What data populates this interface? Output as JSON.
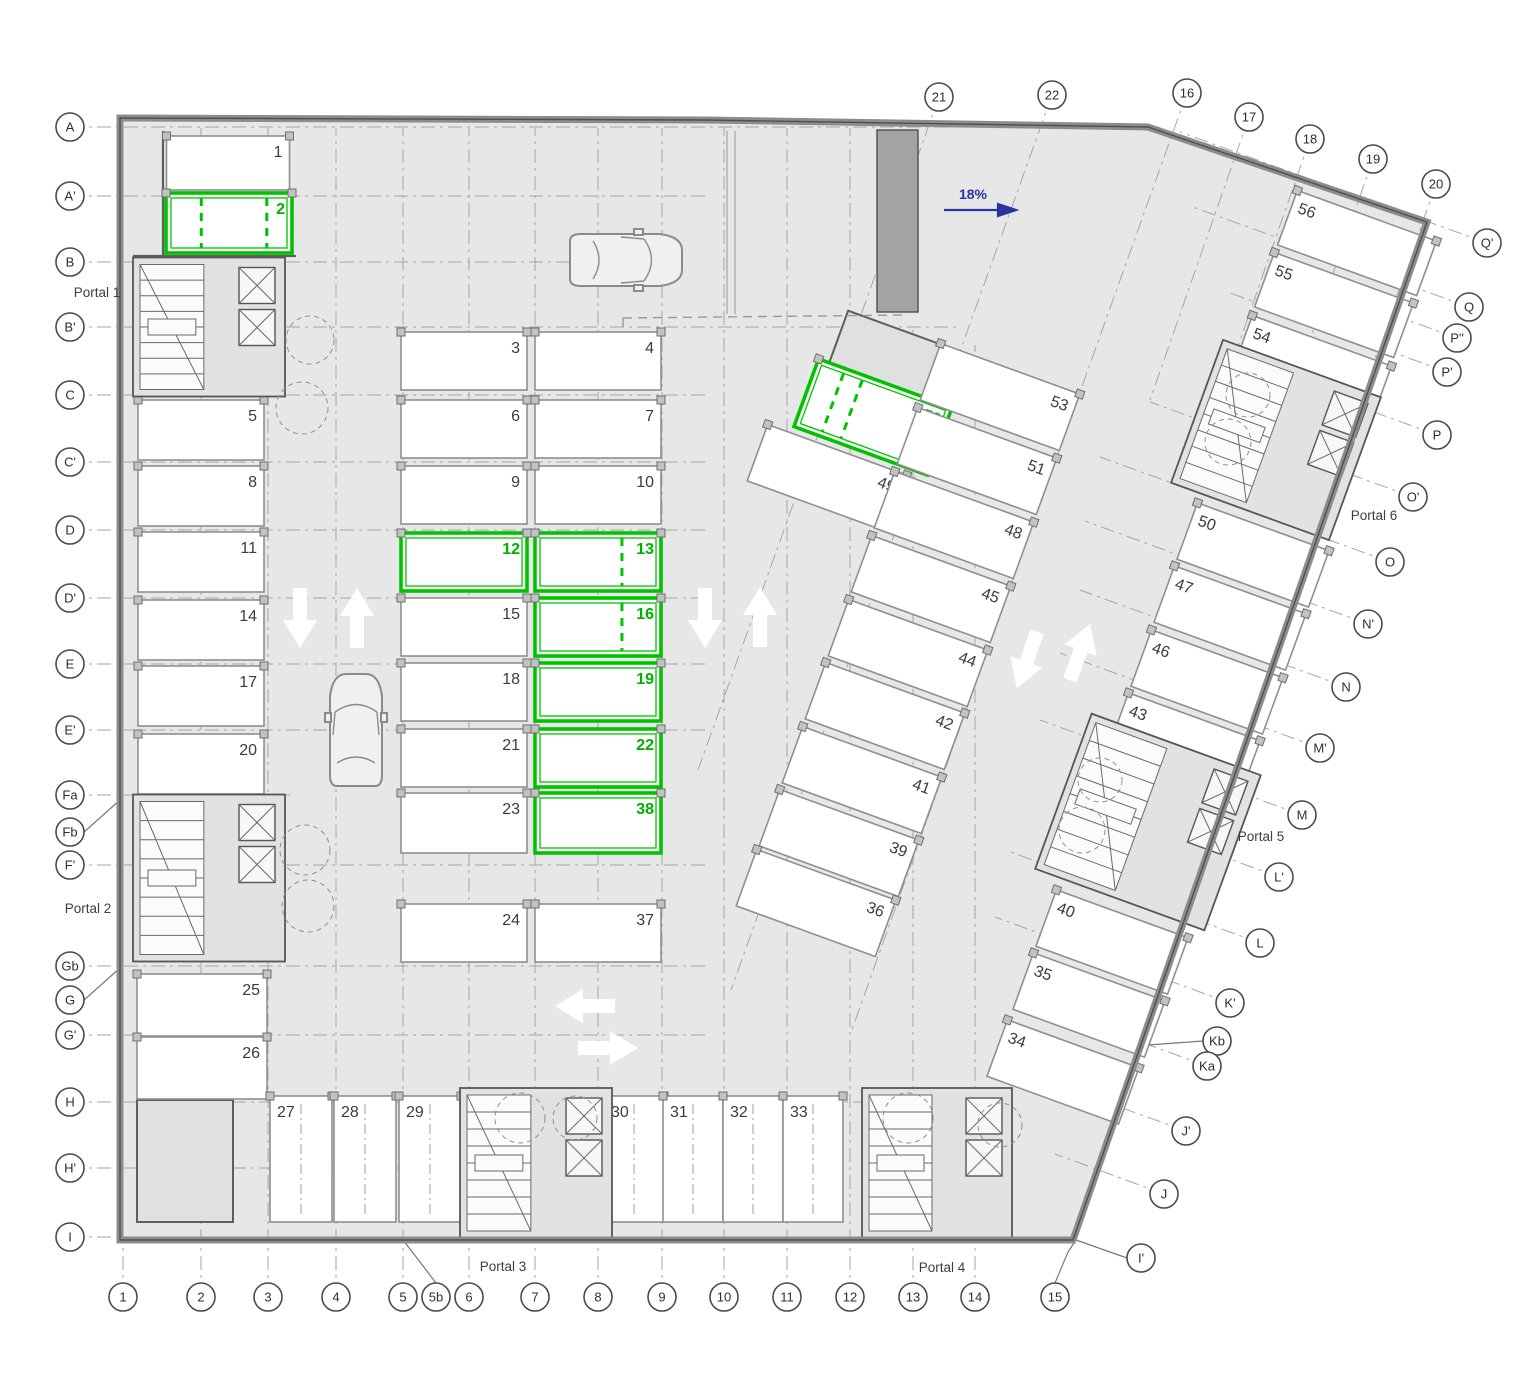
{
  "ramp": {
    "label": "18%",
    "color": "#2a35a0"
  },
  "highlight_color": "#00c300",
  "highlighted_stalls": [
    "2",
    "12",
    "13",
    "16",
    "19",
    "22",
    "38",
    "52"
  ],
  "portals": [
    {
      "t": "Portal 1",
      "x": 97,
      "y": 297
    },
    {
      "t": "Portal 2",
      "x": 88,
      "y": 913
    },
    {
      "t": "Portal 3",
      "x": 503,
      "y": 1271
    },
    {
      "t": "Portal 4",
      "x": 942,
      "y": 1272
    },
    {
      "t": "Portal 5",
      "x": 1261,
      "y": 841
    },
    {
      "t": "Portal 6",
      "x": 1374,
      "y": 520
    }
  ],
  "stalls": [
    {
      "n": "1",
      "x": 228,
      "y": 163,
      "w": 123,
      "h": 54,
      "r": 0,
      "np": "tr"
    },
    {
      "n": "2",
      "x": 229,
      "y": 223,
      "w": 126,
      "h": 60,
      "r": 0,
      "np": "tr",
      "g": true,
      "ds": [
        0.28,
        0.8
      ]
    },
    {
      "n": "3",
      "x": 464,
      "y": 361,
      "w": 126,
      "h": 58,
      "r": 0,
      "np": "tr"
    },
    {
      "n": "4",
      "x": 598,
      "y": 361,
      "w": 126,
      "h": 58,
      "r": 0,
      "np": "tr"
    },
    {
      "n": "6",
      "x": 464,
      "y": 429,
      "w": 126,
      "h": 58,
      "r": 0,
      "np": "tr"
    },
    {
      "n": "7",
      "x": 598,
      "y": 429,
      "w": 126,
      "h": 58,
      "r": 0,
      "np": "tr"
    },
    {
      "n": "9",
      "x": 464,
      "y": 495,
      "w": 126,
      "h": 58,
      "r": 0,
      "np": "tr"
    },
    {
      "n": "10",
      "x": 598,
      "y": 495,
      "w": 126,
      "h": 58,
      "r": 0,
      "np": "tr"
    },
    {
      "n": "12",
      "x": 464,
      "y": 562,
      "w": 126,
      "h": 58,
      "r": 0,
      "np": "tr",
      "g": true
    },
    {
      "n": "13",
      "x": 598,
      "y": 562,
      "w": 126,
      "h": 58,
      "r": 0,
      "np": "tr",
      "g": true,
      "ds": [
        0.69
      ]
    },
    {
      "n": "15",
      "x": 464,
      "y": 627,
      "w": 126,
      "h": 58,
      "r": 0,
      "np": "tr"
    },
    {
      "n": "16",
      "x": 598,
      "y": 627,
      "w": 126,
      "h": 58,
      "r": 0,
      "np": "tr",
      "g": true,
      "ds": [
        0.69
      ]
    },
    {
      "n": "18",
      "x": 464,
      "y": 692,
      "w": 126,
      "h": 58,
      "r": 0,
      "np": "tr"
    },
    {
      "n": "19",
      "x": 598,
      "y": 692,
      "w": 126,
      "h": 58,
      "r": 0,
      "np": "tr",
      "g": true
    },
    {
      "n": "21",
      "x": 464,
      "y": 758,
      "w": 126,
      "h": 58,
      "r": 0,
      "np": "tr"
    },
    {
      "n": "22",
      "x": 598,
      "y": 758,
      "w": 126,
      "h": 58,
      "r": 0,
      "np": "tr",
      "g": true
    },
    {
      "n": "23",
      "x": 464,
      "y": 823,
      "w": 126,
      "h": 60,
      "r": 0,
      "np": "tr"
    },
    {
      "n": "38",
      "x": 598,
      "y": 823,
      "w": 126,
      "h": 60,
      "r": 0,
      "np": "tr",
      "g": true
    },
    {
      "n": "24",
      "x": 464,
      "y": 933,
      "w": 126,
      "h": 58,
      "r": 0,
      "np": "tr"
    },
    {
      "n": "37",
      "x": 598,
      "y": 933,
      "w": 126,
      "h": 58,
      "r": 0,
      "np": "tr"
    },
    {
      "n": "5",
      "x": 201,
      "y": 430,
      "w": 126,
      "h": 60,
      "r": 0,
      "np": "tr"
    },
    {
      "n": "8",
      "x": 201,
      "y": 496,
      "w": 126,
      "h": 60,
      "r": 0,
      "np": "tr"
    },
    {
      "n": "11",
      "x": 201,
      "y": 562,
      "w": 126,
      "h": 60,
      "r": 0,
      "np": "tr"
    },
    {
      "n": "14",
      "x": 201,
      "y": 630,
      "w": 126,
      "h": 60,
      "r": 0,
      "np": "tr"
    },
    {
      "n": "17",
      "x": 201,
      "y": 696,
      "w": 126,
      "h": 60,
      "r": 0,
      "np": "tr"
    },
    {
      "n": "20",
      "x": 201,
      "y": 764,
      "w": 126,
      "h": 60,
      "r": 0,
      "np": "tr"
    },
    {
      "n": "25",
      "x": 202,
      "y": 1005,
      "w": 130,
      "h": 62,
      "r": 0,
      "np": "tr"
    },
    {
      "n": "26",
      "x": 202,
      "y": 1068,
      "w": 130,
      "h": 62,
      "r": 0,
      "np": "tr"
    },
    {
      "n": "27",
      "x": 301,
      "y": 1159,
      "w": 62,
      "h": 126,
      "r": 0,
      "np": "tl"
    },
    {
      "n": "28",
      "x": 365,
      "y": 1159,
      "w": 62,
      "h": 126,
      "r": 0,
      "np": "tl"
    },
    {
      "n": "29",
      "x": 430,
      "y": 1159,
      "w": 62,
      "h": 126,
      "r": 0,
      "np": "tl"
    },
    {
      "n": "30",
      "x": 634,
      "y": 1159,
      "w": 60,
      "h": 126,
      "r": 0,
      "np": "tl"
    },
    {
      "n": "31",
      "x": 693,
      "y": 1159,
      "w": 60,
      "h": 126,
      "r": 0,
      "np": "tl"
    },
    {
      "n": "32",
      "x": 753,
      "y": 1159,
      "w": 60,
      "h": 126,
      "r": 0,
      "np": "tl"
    },
    {
      "n": "33",
      "x": 813,
      "y": 1159,
      "w": 60,
      "h": 126,
      "r": 0,
      "np": "tl"
    },
    {
      "n": "52",
      "x": 873,
      "y": 417,
      "w": 142,
      "h": 72,
      "r": 20,
      "np": "tr",
      "g": true,
      "ds": [
        0.2,
        0.34
      ]
    },
    {
      "n": "49",
      "x": 827,
      "y": 478,
      "w": 148,
      "h": 60,
      "r": 20,
      "np": "tr"
    },
    {
      "n": "53",
      "x": 1000,
      "y": 397,
      "w": 148,
      "h": 60,
      "r": 20,
      "np": "tr"
    },
    {
      "n": "51",
      "x": 977,
      "y": 461,
      "w": 148,
      "h": 60,
      "r": 20,
      "np": "tr"
    },
    {
      "n": "48",
      "x": 954,
      "y": 525,
      "w": 148,
      "h": 60,
      "r": 20,
      "np": "tr"
    },
    {
      "n": "45",
      "x": 931,
      "y": 589,
      "w": 148,
      "h": 60,
      "r": 20,
      "np": "tr"
    },
    {
      "n": "44",
      "x": 908,
      "y": 653,
      "w": 148,
      "h": 60,
      "r": 20,
      "np": "tr"
    },
    {
      "n": "42",
      "x": 885,
      "y": 716,
      "w": 148,
      "h": 60,
      "r": 20,
      "np": "tr"
    },
    {
      "n": "41",
      "x": 862,
      "y": 780,
      "w": 148,
      "h": 60,
      "r": 20,
      "np": "tr"
    },
    {
      "n": "39",
      "x": 839,
      "y": 843,
      "w": 148,
      "h": 60,
      "r": 20,
      "np": "tr"
    },
    {
      "n": "36",
      "x": 816,
      "y": 903,
      "w": 148,
      "h": 60,
      "r": 20,
      "np": "tr"
    },
    {
      "n": "50",
      "x": 1253,
      "y": 555,
      "w": 140,
      "h": 60,
      "r": 20,
      "np": "tl"
    },
    {
      "n": "47",
      "x": 1230,
      "y": 618,
      "w": 140,
      "h": 60,
      "r": 20,
      "np": "tl"
    },
    {
      "n": "46",
      "x": 1207,
      "y": 682,
      "w": 140,
      "h": 60,
      "r": 20,
      "np": "tl"
    },
    {
      "n": "43",
      "x": 1184,
      "y": 745,
      "w": 140,
      "h": 60,
      "r": 20,
      "np": "tl"
    },
    {
      "n": "40",
      "x": 1112,
      "y": 942,
      "w": 140,
      "h": 60,
      "r": 20,
      "np": "tl"
    },
    {
      "n": "35",
      "x": 1089,
      "y": 1005,
      "w": 140,
      "h": 60,
      "r": 20,
      "np": "tl"
    },
    {
      "n": "34",
      "x": 1063,
      "y": 1072,
      "w": 140,
      "h": 60,
      "r": 20,
      "np": "tl"
    },
    {
      "n": "56",
      "x": 1357,
      "y": 243,
      "w": 148,
      "h": 58,
      "r": 20,
      "np": "tl"
    },
    {
      "n": "55",
      "x": 1334,
      "y": 305,
      "w": 148,
      "h": 58,
      "r": 20,
      "np": "tl"
    },
    {
      "n": "54",
      "x": 1312,
      "y": 368,
      "w": 148,
      "h": 58,
      "r": 20,
      "np": "tl"
    }
  ],
  "bubbles": [
    {
      "t": "A",
      "x": 70,
      "y": 127,
      "x2": 1146,
      "y2": 127
    },
    {
      "t": "A'",
      "x": 70,
      "y": 196,
      "x2": 708,
      "y2": 196
    },
    {
      "t": "B",
      "x": 70,
      "y": 262,
      "x2": 655,
      "y2": 262
    },
    {
      "t": "B'",
      "x": 70,
      "y": 327,
      "x2": 960,
      "y2": 327
    },
    {
      "t": "C",
      "x": 70,
      "y": 395,
      "x2": 708,
      "y2": 395
    },
    {
      "t": "C'",
      "x": 70,
      "y": 462,
      "x2": 708,
      "y2": 462
    },
    {
      "t": "D",
      "x": 70,
      "y": 530,
      "x2": 708,
      "y2": 530
    },
    {
      "t": "D'",
      "x": 70,
      "y": 598,
      "x2": 708,
      "y2": 598
    },
    {
      "t": "E",
      "x": 70,
      "y": 664,
      "x2": 708,
      "y2": 664
    },
    {
      "t": "E'",
      "x": 70,
      "y": 730,
      "x2": 708,
      "y2": 730
    },
    {
      "t": "Fa",
      "x": 70,
      "y": 795,
      "x2": 290,
      "y2": 795
    },
    {
      "t": "Fb",
      "x": 70,
      "y": 832
    },
    {
      "t": "F'",
      "x": 70,
      "y": 865,
      "x2": 708,
      "y2": 865
    },
    {
      "t": "Gb",
      "x": 70,
      "y": 966,
      "x2": 708,
      "y2": 966
    },
    {
      "t": "G",
      "x": 70,
      "y": 1000
    },
    {
      "t": "G'",
      "x": 70,
      "y": 1035,
      "x2": 708,
      "y2": 1035
    },
    {
      "t": "H",
      "x": 70,
      "y": 1102,
      "x2": 862,
      "y2": 1102
    },
    {
      "t": "H'",
      "x": 70,
      "y": 1168,
      "x2": 465,
      "y2": 1168
    },
    {
      "t": "I",
      "x": 70,
      "y": 1237,
      "x2": 1073,
      "y2": 1237
    },
    {
      "t": "1",
      "x": 123,
      "y": 1297,
      "x2": 123,
      "y2": 128
    },
    {
      "t": "2",
      "x": 201,
      "y": 1297,
      "x2": 201,
      "y2": 128
    },
    {
      "t": "3",
      "x": 268,
      "y": 1297,
      "x2": 268,
      "y2": 128
    },
    {
      "t": "4",
      "x": 336,
      "y": 1297,
      "x2": 336,
      "y2": 128
    },
    {
      "t": "5",
      "x": 403,
      "y": 1297,
      "x2": 403,
      "y2": 128
    },
    {
      "t": "5b",
      "x": 436,
      "y": 1297
    },
    {
      "t": "6",
      "x": 469,
      "y": 1297,
      "x2": 469,
      "y2": 128
    },
    {
      "t": "7",
      "x": 535,
      "y": 1297,
      "x2": 535,
      "y2": 128
    },
    {
      "t": "8",
      "x": 598,
      "y": 1297,
      "x2": 598,
      "y2": 128
    },
    {
      "t": "9",
      "x": 662,
      "y": 1297,
      "x2": 662,
      "y2": 128
    },
    {
      "t": "10",
      "x": 724,
      "y": 1297,
      "x2": 724,
      "y2": 128
    },
    {
      "t": "11",
      "x": 787,
      "y": 1297,
      "x2": 787,
      "y2": 128
    },
    {
      "t": "12",
      "x": 850,
      "y": 1297,
      "x2": 850,
      "y2": 128
    },
    {
      "t": "13",
      "x": 913,
      "y": 1297,
      "x2": 913,
      "y2": 330
    },
    {
      "t": "14",
      "x": 975,
      "y": 1297,
      "x2": 975,
      "y2": 345
    },
    {
      "t": "15",
      "x": 1055,
      "y": 1297
    },
    {
      "t": "21",
      "x": 939,
      "y": 97,
      "x2": 698,
      "y2": 770
    },
    {
      "t": "22",
      "x": 1052,
      "y": 95,
      "x2": 731,
      "y2": 990
    },
    {
      "t": "16",
      "x": 1187,
      "y": 93,
      "x2": 850,
      "y2": 1035
    },
    {
      "t": "17",
      "x": 1249,
      "y": 117,
      "x2": 1150,
      "y2": 400
    },
    {
      "t": "18",
      "x": 1310,
      "y": 139,
      "x2": 1209,
      "y2": 430
    },
    {
      "t": "19",
      "x": 1373,
      "y": 159,
      "x2": 1268,
      "y2": 460
    },
    {
      "t": "20",
      "x": 1436,
      "y": 184,
      "x2": 1329,
      "y2": 490
    },
    {
      "t": "Q'",
      "x": 1487,
      "y": 243,
      "x2": 1180,
      "y2": 132
    },
    {
      "t": "Q",
      "x": 1469,
      "y": 307,
      "x2": 1190,
      "y2": 206
    },
    {
      "t": "P''",
      "x": 1457,
      "y": 338,
      "x2": 1300,
      "y2": 281
    },
    {
      "t": "P'",
      "x": 1447,
      "y": 372,
      "x2": 1230,
      "y2": 293
    },
    {
      "t": "P",
      "x": 1437,
      "y": 435,
      "x2": 1245,
      "y2": 365
    },
    {
      "t": "O'",
      "x": 1413,
      "y": 497,
      "x2": 1150,
      "y2": 402
    },
    {
      "t": "O",
      "x": 1390,
      "y": 562,
      "x2": 1100,
      "y2": 457
    },
    {
      "t": "N'",
      "x": 1368,
      "y": 624,
      "x2": 1085,
      "y2": 521
    },
    {
      "t": "N",
      "x": 1346,
      "y": 687,
      "x2": 1080,
      "y2": 590
    },
    {
      "t": "M'",
      "x": 1320,
      "y": 748,
      "x2": 1060,
      "y2": 653
    },
    {
      "t": "M",
      "x": 1302,
      "y": 815,
      "x2": 1040,
      "y2": 720
    },
    {
      "t": "L'",
      "x": 1279,
      "y": 877,
      "x2": 1082,
      "y2": 805
    },
    {
      "t": "L",
      "x": 1260,
      "y": 943,
      "x2": 1008,
      "y2": 851
    },
    {
      "t": "K'",
      "x": 1230,
      "y": 1003,
      "x2": 995,
      "y2": 917
    },
    {
      "t": "Kb",
      "x": 1217,
      "y": 1041
    },
    {
      "t": "Ka",
      "x": 1207,
      "y": 1066,
      "x2": 1058,
      "y2": 1012
    },
    {
      "t": "J'",
      "x": 1186,
      "y": 1131,
      "x2": 1078,
      "y2": 1092
    },
    {
      "t": "J",
      "x": 1164,
      "y": 1194,
      "x2": 1055,
      "y2": 1154
    },
    {
      "t": "I'",
      "x": 1141,
      "y": 1258
    }
  ],
  "leaders": [
    {
      "p": "84,832 120,800"
    },
    {
      "p": "84,1000 120,968"
    },
    {
      "p": "1203,1041 1120,1047 1085,1028"
    },
    {
      "p": "436,1283 420,1262 403,1240"
    },
    {
      "p": "1055,1283 1068,1252 1076,1240"
    },
    {
      "p": "1127,1258 1076,1240"
    }
  ],
  "cores": [
    {
      "x": 209,
      "y": 327,
      "w": 152,
      "h": 139,
      "r": 0
    },
    {
      "x": 209,
      "y": 878,
      "w": 152,
      "h": 167,
      "r": 0
    },
    {
      "x": 536,
      "y": 1163,
      "w": 152,
      "h": 150,
      "r": 0
    },
    {
      "x": 937,
      "y": 1163,
      "w": 150,
      "h": 150,
      "r": 0
    },
    {
      "x": 1148,
      "y": 822,
      "w": 180,
      "h": 165,
      "r": 20
    },
    {
      "x": 1276,
      "y": 440,
      "w": 168,
      "h": 152,
      "r": 20
    }
  ],
  "arrows": [
    {
      "x": 300,
      "y": 618,
      "r": 0
    },
    {
      "x": 357,
      "y": 618,
      "r": 180
    },
    {
      "x": 705,
      "y": 618,
      "r": 0
    },
    {
      "x": 760,
      "y": 617,
      "r": 180
    },
    {
      "x": 1027,
      "y": 660,
      "r": 20
    },
    {
      "x": 1080,
      "y": 652,
      "r": 200
    },
    {
      "x": 585,
      "y": 1006,
      "r": 90
    },
    {
      "x": 608,
      "y": 1048,
      "r": 270
    }
  ],
  "cars": [
    {
      "x": 626,
      "y": 260,
      "r": 0
    },
    {
      "x": 356,
      "y": 730,
      "r": -90
    }
  ]
}
